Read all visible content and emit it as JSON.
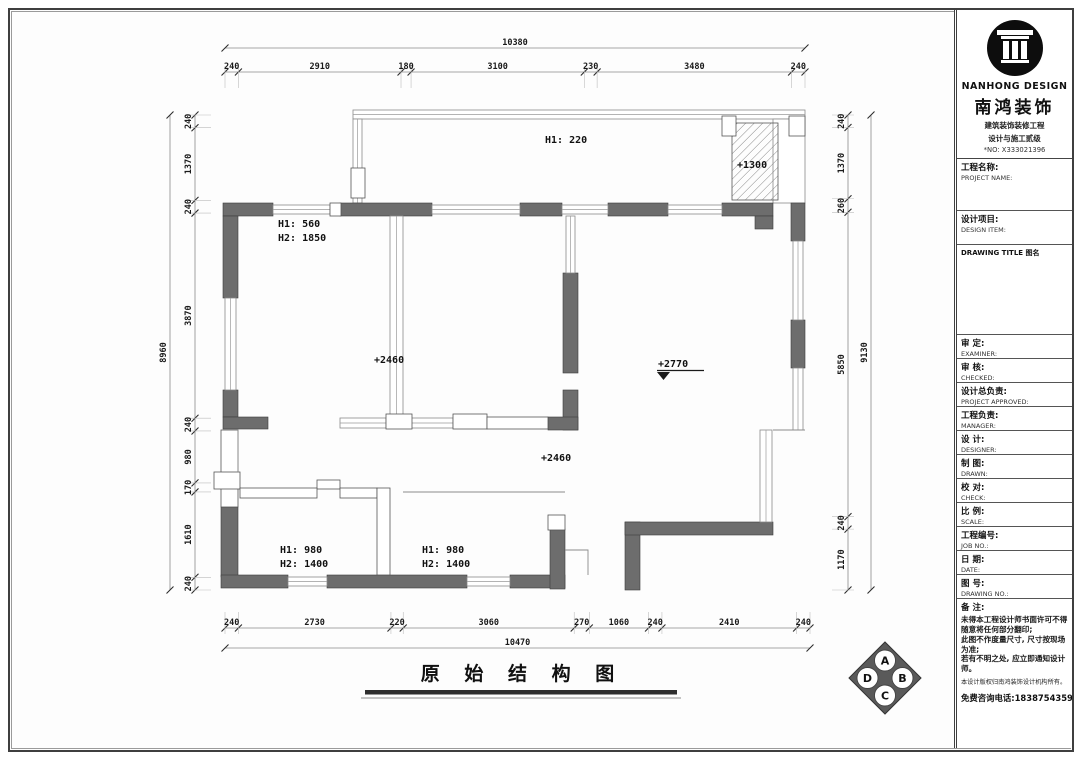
{
  "page": {
    "bg": "#ffffff",
    "frame_color": "#3f3f3f"
  },
  "plan": {
    "title": "原 始 结 构 图",
    "labels": {
      "balcony_h": "H1: 220",
      "bay_level": "+1300",
      "room1_h1": "H1: 560",
      "room1_h2": "H2: 1850",
      "level_mid": "+2460",
      "level_living": "+2770",
      "level_corridor": "+2460",
      "room3_h1": "H1: 980",
      "room3_h2": "H2: 1400",
      "room4_h1": "H1: 980",
      "room4_h2": "H2: 1400"
    },
    "dims": {
      "top": {
        "total": "10380",
        "segments": [
          "240",
          "2910",
          "180",
          "3100",
          "230",
          "3480",
          "240"
        ]
      },
      "bottom": {
        "total": "10470",
        "segments": [
          "240",
          "2730",
          "220",
          "3060",
          "270",
          "1060",
          "240",
          "2410",
          "240"
        ]
      },
      "left": {
        "total": "8960",
        "segments": [
          "240",
          "1370",
          "240",
          "3870",
          "240",
          "980",
          "170",
          "1610",
          "240"
        ]
      },
      "right": {
        "total": "9130",
        "segments": [
          "240",
          "1370",
          "260",
          "5850",
          "240",
          "1170"
        ]
      }
    },
    "compass": {
      "top": "A",
      "right": "B",
      "bottom": "C",
      "left": "D"
    }
  },
  "titleblock": {
    "brand_en": "NANHONG DESIGN",
    "brand_cn": "南鸿装饰",
    "cert_line1": "建筑装饰装修工程",
    "cert_line2": "设计与施工贰级",
    "cert_no": "*NO: X333021396",
    "drawing_title_label": "DRAWING TITLE 图名",
    "fields": [
      {
        "cn": "工程名称:",
        "en": "PROJECT NAME:"
      },
      {
        "cn": "设计项目:",
        "en": "DESIGN ITEM:"
      },
      {
        "cn": "审  定:",
        "en": "EXAMINER:"
      },
      {
        "cn": "审  核:",
        "en": "CHECKED:"
      },
      {
        "cn": "设计总负责:",
        "en": "PROJECT APPROVED:"
      },
      {
        "cn": "工程负责:",
        "en": "MANAGER:"
      },
      {
        "cn": "设  计:",
        "en": "DESIGNER:"
      },
      {
        "cn": "制  图:",
        "en": "DRAWN:"
      },
      {
        "cn": "校  对:",
        "en": "CHECK:"
      },
      {
        "cn": "比  例:",
        "en": "SCALE:"
      },
      {
        "cn": "工程编号:",
        "en": "JOB NO.:"
      },
      {
        "cn": "日  期:",
        "en": "DATE:"
      },
      {
        "cn": "图  号:",
        "en": "DRAWING NO.:"
      }
    ],
    "remarks_label": "备  注:",
    "remarks": [
      "未得本工程设计师书面许可不得",
      "随意将任何部分翻印;",
      "此图不作度量尺寸, 尺寸按现场",
      "为准;",
      "若有不明之处, 应立即通知设计",
      "师。"
    ],
    "copyright": "本设计版权归南鸿装饰设计机构所有。",
    "hotline": "免费咨询电话:18387543593"
  }
}
